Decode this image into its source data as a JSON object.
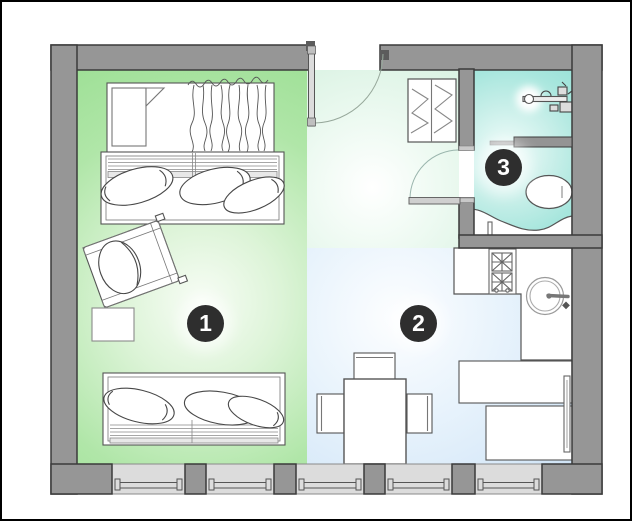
{
  "floor_plan": {
    "title": "studio-apartment-floor-plan",
    "rooms": [
      {
        "number": "1",
        "zone": "living-room",
        "floor_color": "#a9e4a1"
      },
      {
        "number": "2",
        "zone": "kitchen-dining",
        "floor_color": "#d5e8f7"
      },
      {
        "number": "3",
        "zone": "bathroom",
        "floor_color": "#a5e6dd"
      }
    ],
    "palette": {
      "wall_fill": "#969696",
      "wall_outline": "#3a3a3a",
      "window_band": "#dcdcdc",
      "furniture_line": "#555555",
      "badge_background": "#2e2e2e",
      "badge_text": "#ffffff",
      "page_border": "#000000"
    }
  }
}
